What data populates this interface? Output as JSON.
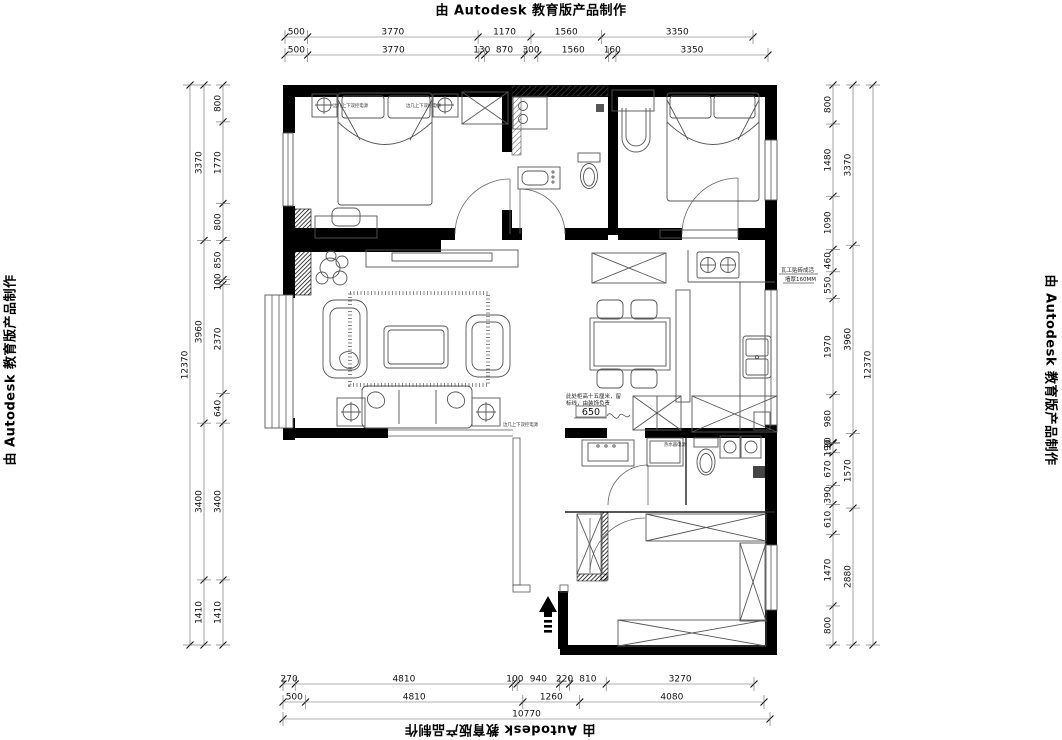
{
  "watermark": {
    "text": "由 Autodesk 教育版产品制作"
  },
  "dimensions": {
    "top": {
      "row1": [
        "500",
        "3770",
        "1170",
        "1560",
        "3350"
      ],
      "row2": [
        "500",
        "3770",
        "130",
        "870",
        "300",
        "1560",
        "160",
        "3350"
      ]
    },
    "bottom": {
      "row1": [
        "270",
        "4810",
        "100",
        "940",
        "220",
        "810",
        "3270"
      ],
      "row2": [
        "500",
        "4810",
        "1260",
        "4080"
      ],
      "row3": [
        "10770"
      ]
    },
    "left": {
      "col_outer": [
        "12370"
      ],
      "col_mid": [
        "3370",
        "3960",
        "3400",
        "1410"
      ],
      "col_inner": [
        "800",
        "1770",
        "800",
        "850",
        "100",
        "2370",
        "640",
        "3400",
        "1410"
      ]
    },
    "right": {
      "col_inner": [
        "800",
        "1480",
        "1090",
        "460",
        "550",
        "1970",
        "980",
        "20",
        "190",
        "670",
        "390",
        "610",
        "1470",
        "800"
      ],
      "col_mid": [
        "3370",
        "3960",
        "1570",
        "2880"
      ],
      "col_outer": [
        "12370"
      ]
    }
  },
  "annotations": {
    "kitchen_note": {
      "line1": "瓦工贴砖成活",
      "line2": "墙厚160MM"
    },
    "cabinet_note": {
      "line1": "此处柜高十五厘米，留",
      "line2": "标线，由装饰负责",
      "dim": "650"
    },
    "bedside_power_left": "边几上下双控电源",
    "bedside_power_right": "边几上下双控电源",
    "sofa_power": "边几上下双控电源",
    "heater_note": "热水器电源"
  }
}
